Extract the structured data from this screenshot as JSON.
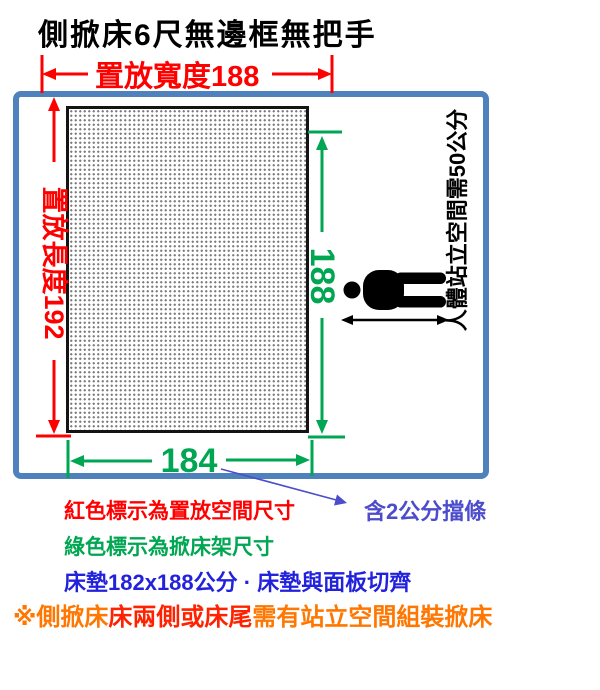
{
  "title": "側掀床6尺無邊框無把手",
  "diagram": {
    "placement_width_label": "置放寬度188",
    "placement_length_label": "置放長度192",
    "bed_length_label": "188",
    "bed_width_label": "184",
    "standing_space_label": "人體站立空間需50公分",
    "person_icon": "person-lying-icon"
  },
  "annotations": {
    "bumper_note": "含2公分擋條"
  },
  "legend": {
    "red_note": "紅色標示為置放空間尺寸",
    "green_note": "綠色標示為掀床架尺寸",
    "mattress_note": "床墊182x188公分 · 床墊與面板切齊"
  },
  "warning": {
    "part1": "※側掀床",
    "part2": "床兩側或床尾",
    "part3": "需有站立空間組裝掀床"
  },
  "colors": {
    "placement_dimension_red": "#ff0000",
    "bed_dimension_green": "#00a651",
    "frame_border_blue": "#4f81bd",
    "mattress_note_blue": "#2222dd",
    "bumper_note_violet": "#4d4dcb",
    "warning_orange": "#ff7700",
    "warning_red": "#ff2200"
  }
}
